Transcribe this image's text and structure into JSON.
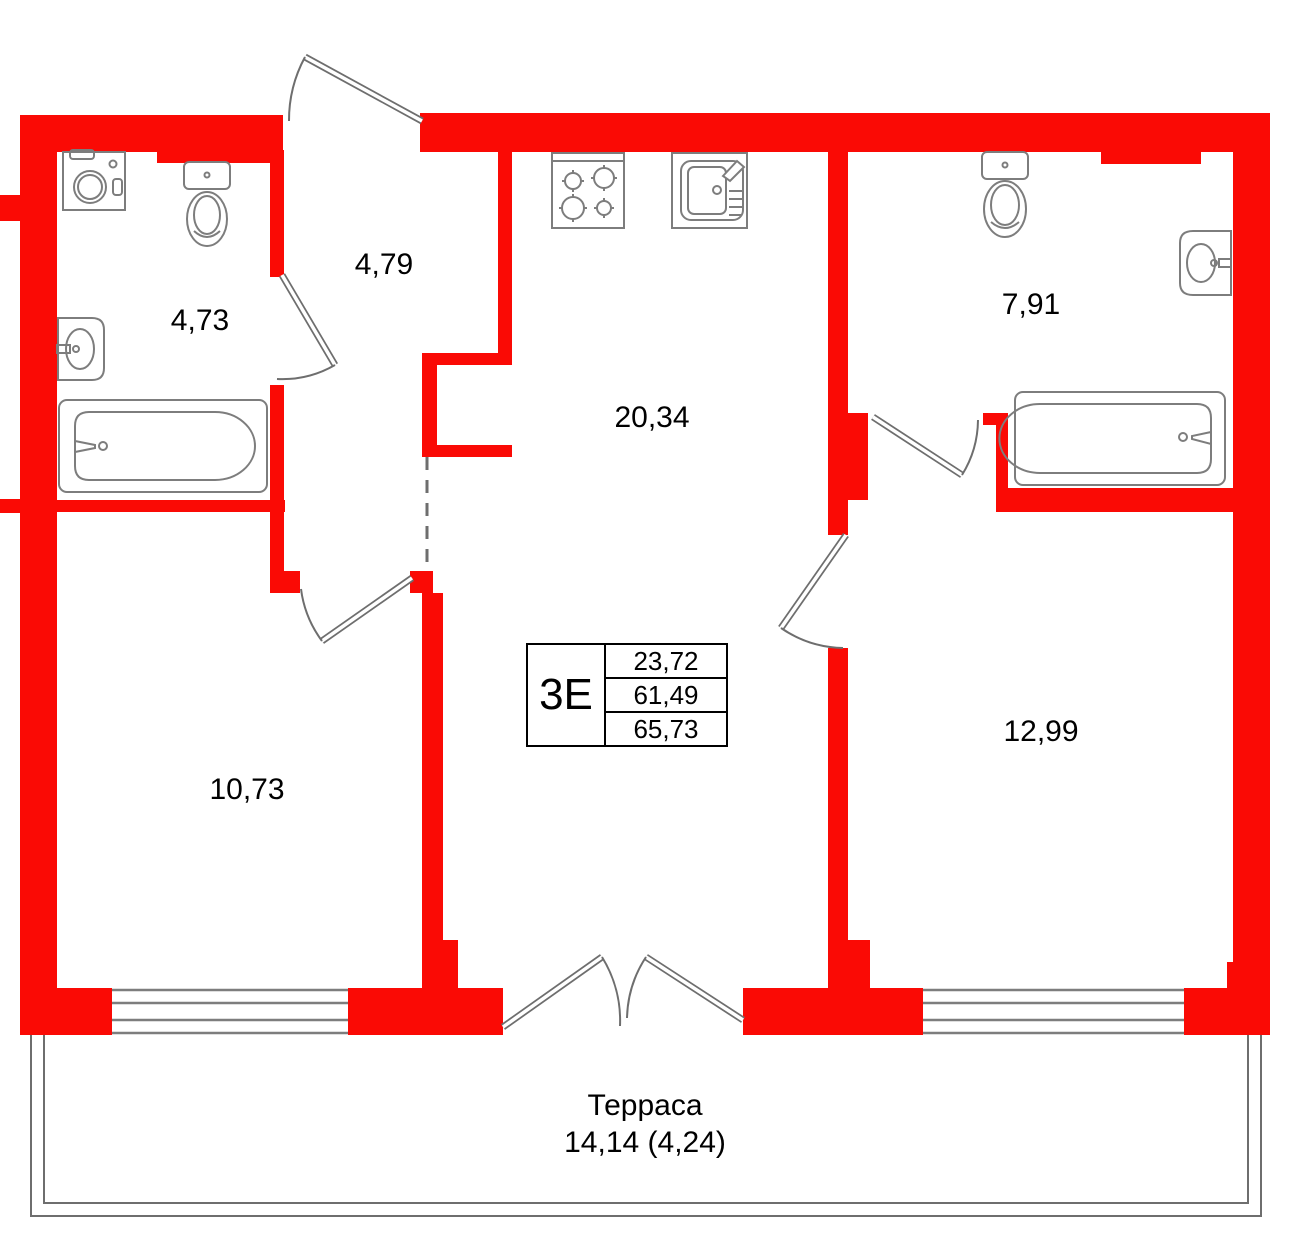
{
  "plan": {
    "unit_box": {
      "type_label": "3Е",
      "rows": [
        "23,72",
        "61,49",
        "65,73"
      ]
    },
    "rooms": [
      {
        "id": "bathroom-1",
        "area_label": "4,73"
      },
      {
        "id": "hallway",
        "area_label": "4,79"
      },
      {
        "id": "kitchen-living",
        "area_label": "20,34"
      },
      {
        "id": "bathroom-2",
        "area_label": "7,91"
      },
      {
        "id": "bedroom-1",
        "area_label": "10,73"
      },
      {
        "id": "bedroom-2",
        "area_label": "12,99"
      }
    ],
    "terrace": {
      "name_label": "Терраса",
      "area_label": "14,14 (4,24)"
    },
    "fixtures": [
      "washing-machine",
      "toilet",
      "sink",
      "bathtub",
      "stove",
      "kitchen-sink",
      "toilet",
      "sink",
      "bathtub"
    ],
    "colors": {
      "wall": "#FA0A05",
      "fixture_outline": "#7D7D7D",
      "door_line": "#6E6E6E",
      "text": "#000000",
      "background": "#FFFFFF"
    }
  }
}
